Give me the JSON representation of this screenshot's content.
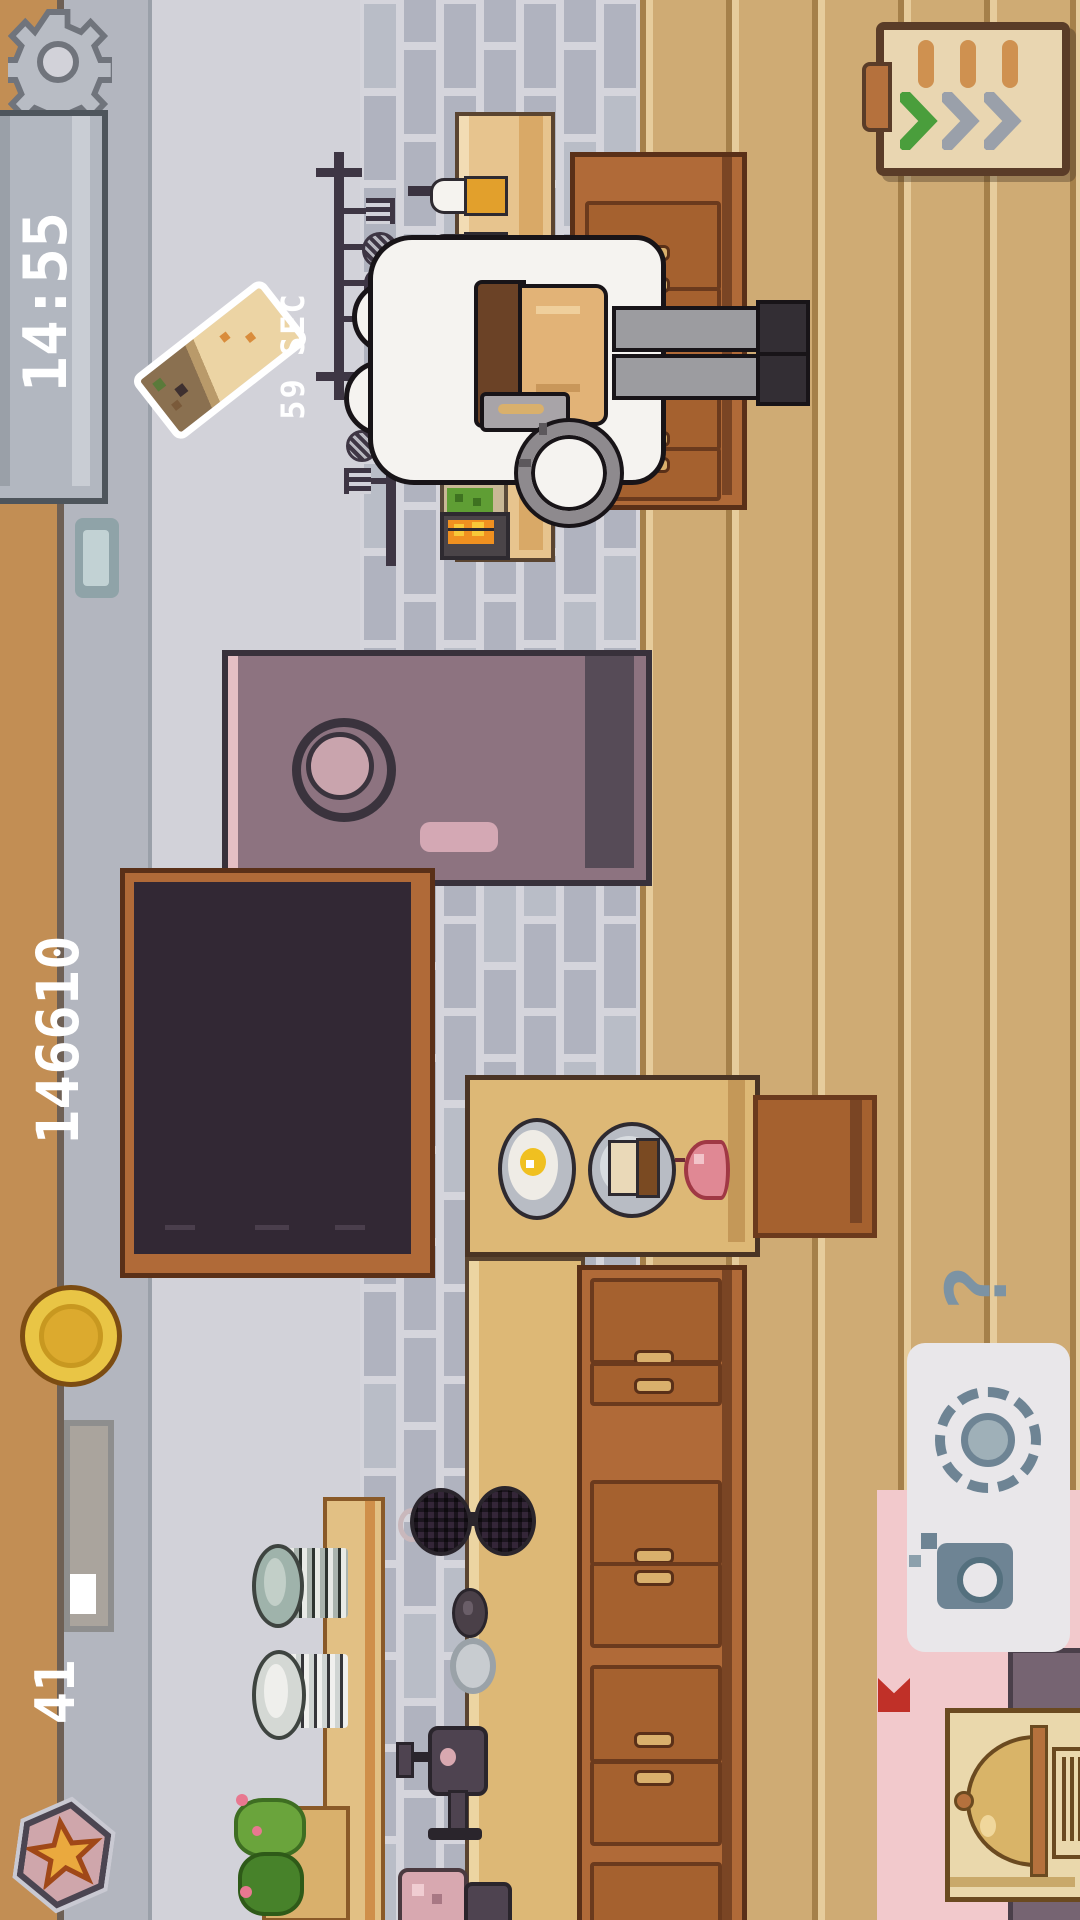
{
  "hud": {
    "settings": {
      "icon": "gear-icon"
    },
    "timer": {
      "value": "14:55"
    },
    "order": {
      "item_icon": "wrap-order-icon",
      "countdown": "59 SEC"
    },
    "score": {
      "coin_icon": "coin-icon",
      "value": "146610"
    },
    "level": {
      "value": "41",
      "progress_percent": 22
    },
    "league_badge": {
      "icon": "star-icon"
    },
    "delivery_board": {
      "icon": "clipboard-icon",
      "chevrons_done": 1,
      "chevrons_total": 3
    },
    "help": {
      "value": "?"
    }
  },
  "colors": {
    "wall_strip": "#c28e54",
    "wall_gray_dark": "#b3b6bf",
    "wall_gray_light": "#d2d2d9",
    "tile_brick": "#b0b3bf",
    "tile_grout": "#d5d5dc",
    "wood_floor": "#cfab74",
    "wood_line_dark": "#a5804a",
    "wood_line_light": "#e6cc9c",
    "hud_bar": "#b2b7c0",
    "hud_text": "#ffffff",
    "coin": "#e9c545",
    "progress_fill": "#ffffff",
    "progress_track": "#aaa49d",
    "badge_face": "#cfa6ab",
    "badge_star": "#eaa93e",
    "cabinet": "#b06a38",
    "drawer": "#a5612f",
    "counter_top": "#ddb876",
    "purple_table": "#8d7380",
    "dark_table": "#322834",
    "pink_rug": "#f2c9cc",
    "panel_white": "#e9e7ea",
    "panel_icon": "#6e8494",
    "bell_station": "#ead8ac",
    "bell_dome": "#d9b468",
    "flag_red": "#c03028",
    "chevron_green": "#4a9e3c",
    "chevron_gray": "#9aa0aa",
    "bottle_caps": [
      "#e2a02c",
      "#8cc84a",
      "#e3cf46"
    ],
    "flame": "#f09020"
  },
  "scene": {
    "floors": [
      "wall-strip",
      "back-wall",
      "tile-floor",
      "wood-floor",
      "pink-rug"
    ],
    "character": "sheep-chef",
    "stations": [
      "prep-counter",
      "grill-station",
      "ingredient-tray",
      "utensil-rack",
      "sauce-bottles",
      "purple-table",
      "dark-table",
      "serving-table",
      "chair",
      "lower-counter",
      "cabinets",
      "waffle-iron",
      "grinder",
      "plate-stacks",
      "planter",
      "dish-panel",
      "bell-station"
    ]
  }
}
